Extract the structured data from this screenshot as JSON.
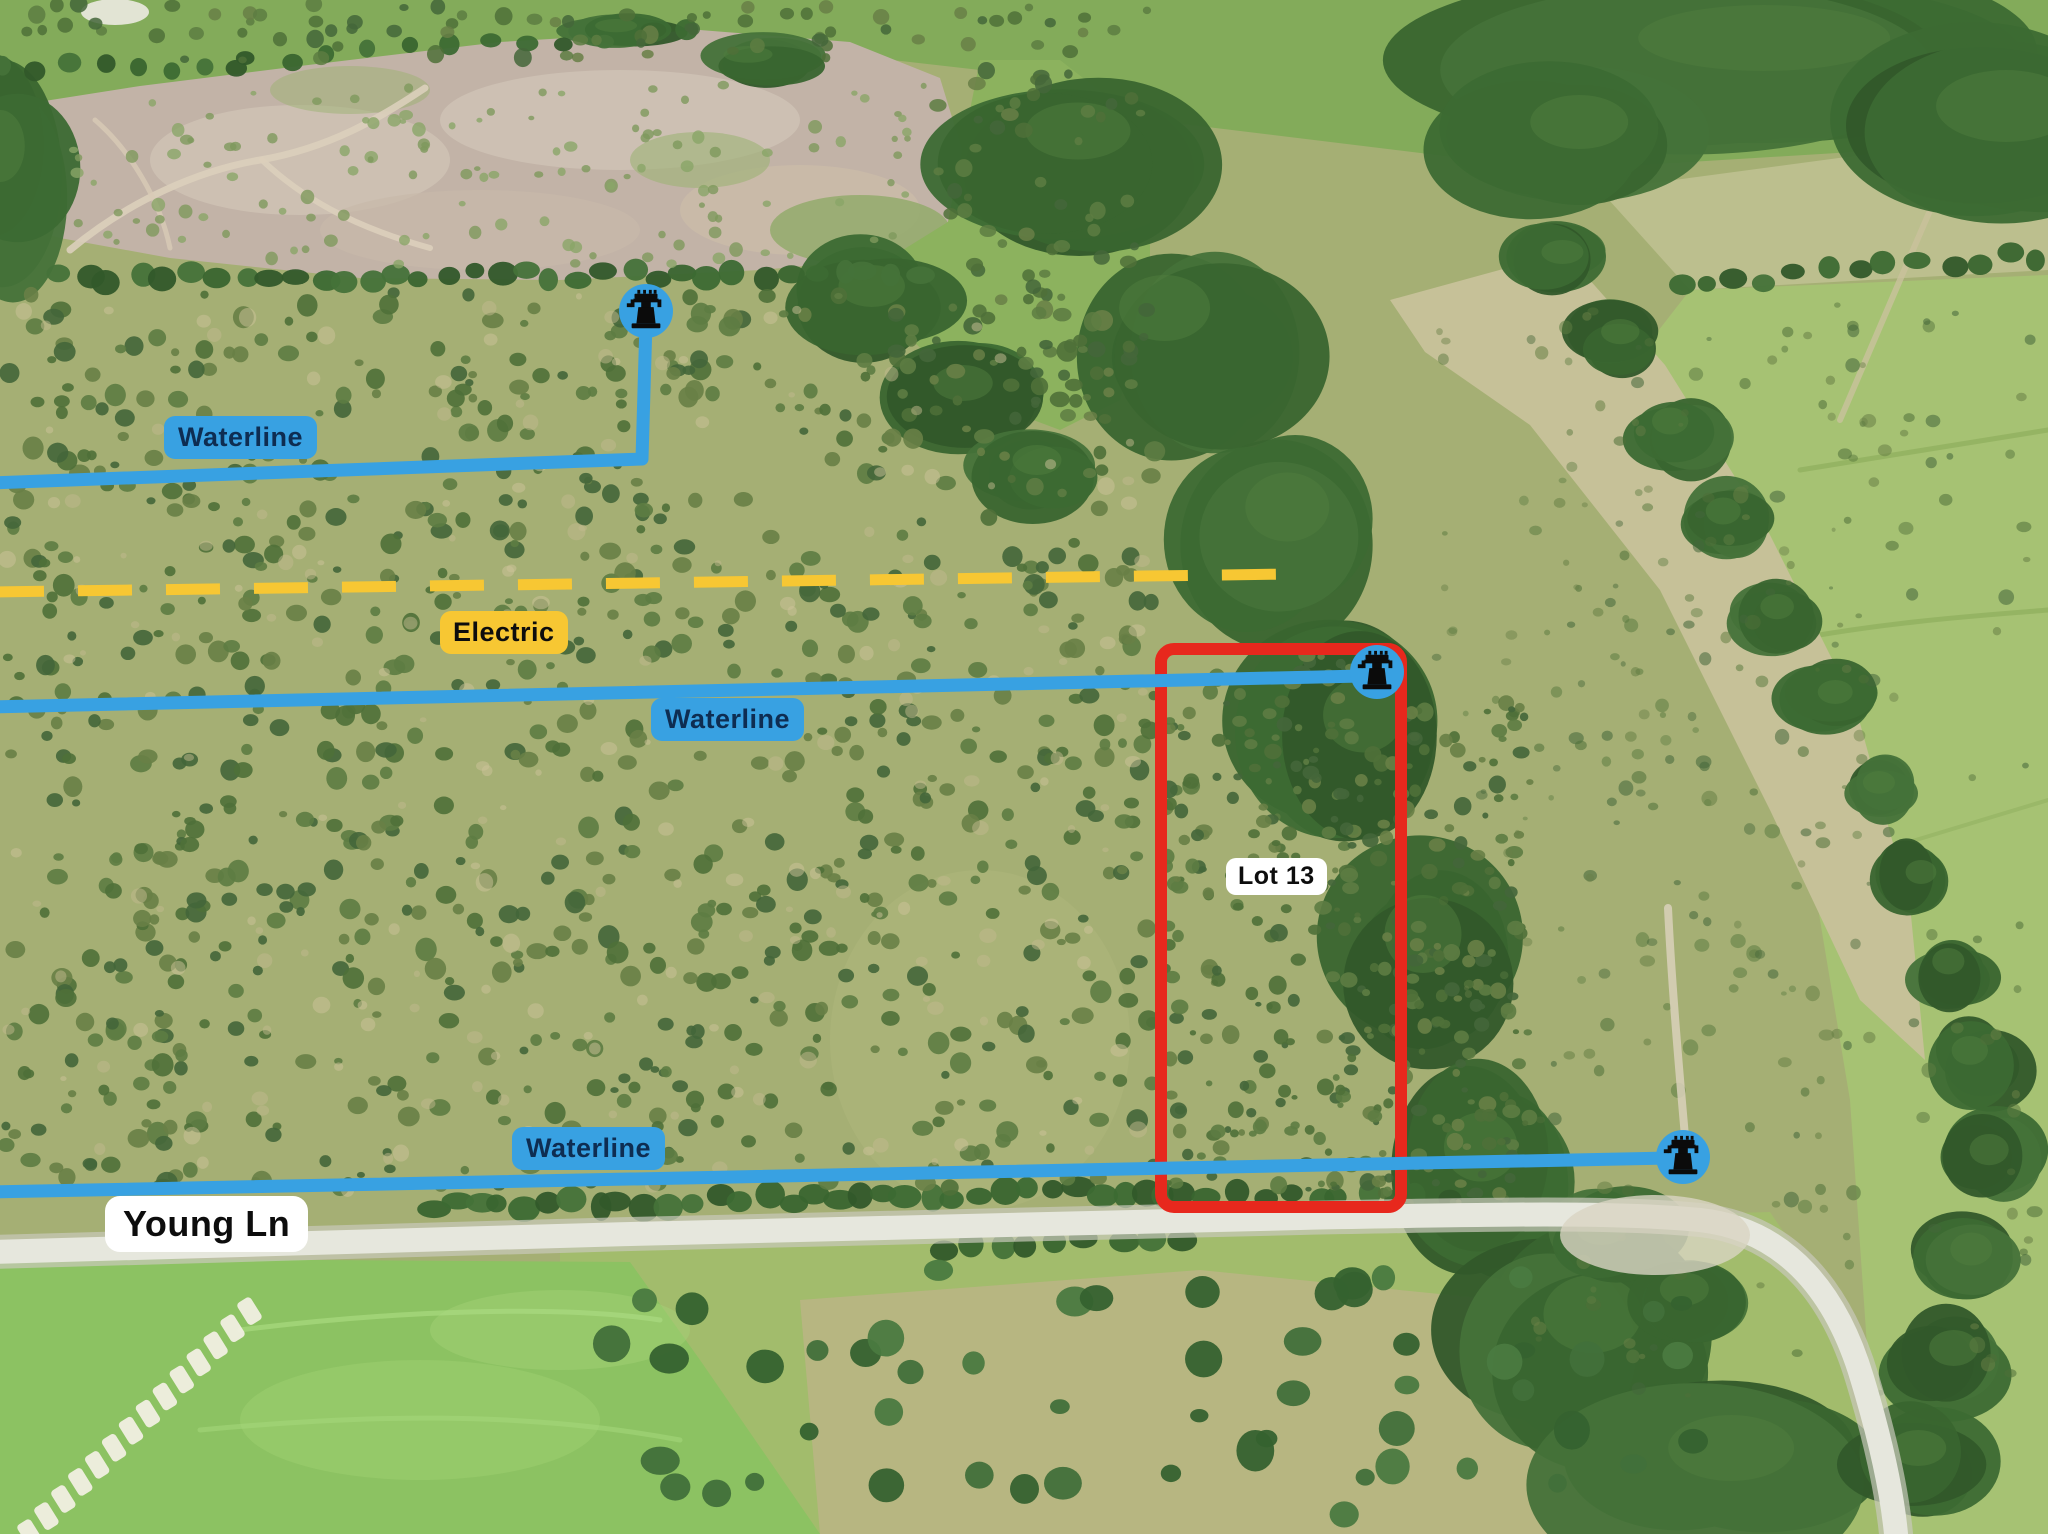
{
  "map": {
    "title": "Aerial property map with utility annotations",
    "road_label": {
      "text": "Young Ln"
    },
    "lot": {
      "label": "Lot 13"
    },
    "utility_labels": {
      "waterline_upper": "Waterline",
      "waterline_middle": "Waterline",
      "waterline_lower": "Waterline",
      "electric": "Electric"
    },
    "icons": {
      "well_upper": "water-well-icon",
      "well_middle": "water-well-icon",
      "well_lower": "water-well-icon"
    },
    "colors": {
      "waterline_blue": "#38A1E2",
      "label_navy": "#0E2D52",
      "electric_yellow": "#F7C733",
      "lot_red": "#E7281D",
      "label_white": "#FFFFFF",
      "label_black": "#0D0D0D",
      "well_black": "#0B0B0B"
    }
  }
}
